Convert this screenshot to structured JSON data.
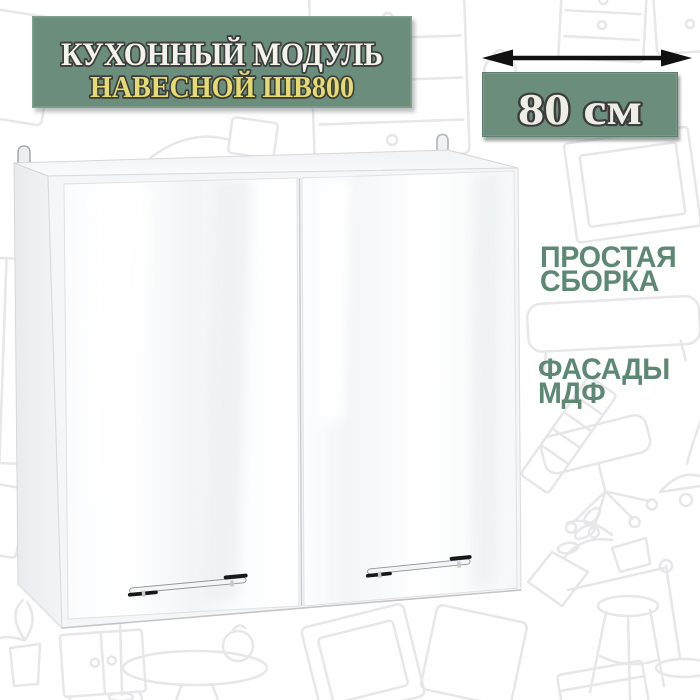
{
  "banner": {
    "title": "КУХОННЫЙ МОДУЛЬ",
    "subtitle": "НАВЕСНОЙ ШВ800"
  },
  "dimension": {
    "width_label": "80 см",
    "arrow_icon": "double-headed-horizontal-arrow"
  },
  "features": {
    "assembly": {
      "line1": "ПРОСТАЯ",
      "line2": "СБОРКА"
    },
    "facade": {
      "line1": "ФАСАДЫ",
      "line2": "МДФ"
    }
  },
  "product": {
    "illustration": "white-glossy-two-door-wall-cabinet",
    "details": [
      "left-door-handle",
      "right-door-handle",
      "two-hanging-loops"
    ]
  },
  "background": {
    "style": "faint-furniture-line-doodles"
  },
  "colors": {
    "banner_bg": "#6B8E7C",
    "banner_title": "#F3F3EC",
    "banner_subtitle": "#E6DB70",
    "dimension_label": "#EDEFE6",
    "feature_text": "#5C8874",
    "arrow": "#111111",
    "doodle_line": "#E7E7E9",
    "cabinet_body": "#F5F6F8"
  }
}
